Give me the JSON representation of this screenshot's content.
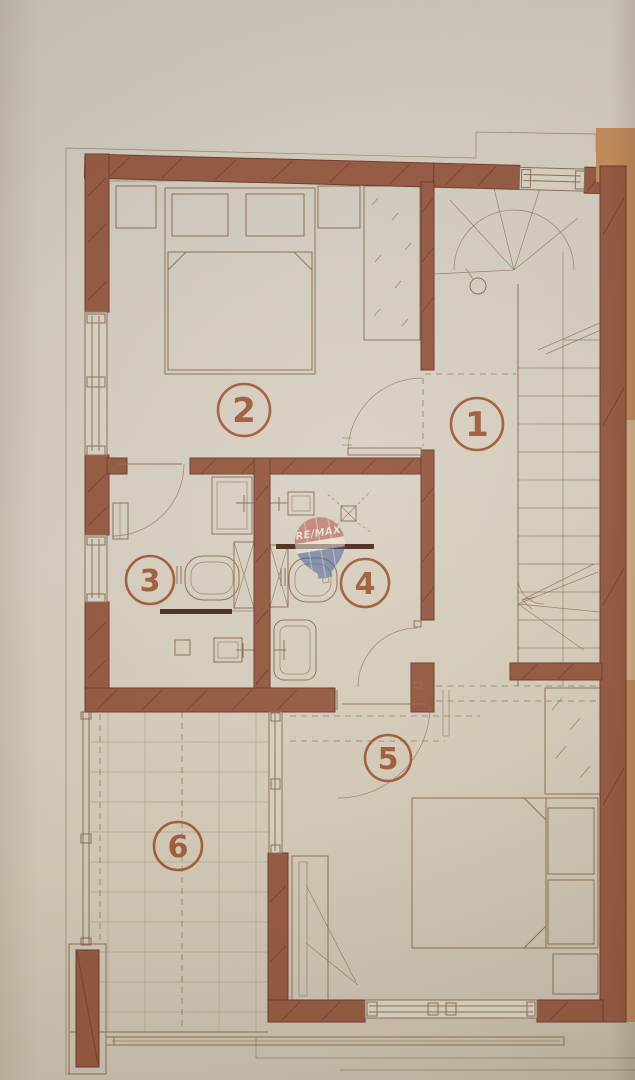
{
  "watermark": {
    "text": "RE/MAX"
  },
  "rooms": [
    {
      "label": "1"
    },
    {
      "label": "2"
    },
    {
      "label": "3"
    },
    {
      "label": "4"
    },
    {
      "label": "5"
    },
    {
      "label": "6"
    }
  ],
  "colors": {
    "paper": "#d6cec0",
    "wall": "#94563e",
    "wall_dark": "#6d3626",
    "line": "#8a6d52",
    "line_light": "#b3a68f",
    "accent": "#a05a36",
    "fixture_dark": "#4a2817",
    "adjacent_orange": "#c48a58",
    "balloon_red": "#b5473e",
    "balloon_blue": "#3c5a96"
  }
}
